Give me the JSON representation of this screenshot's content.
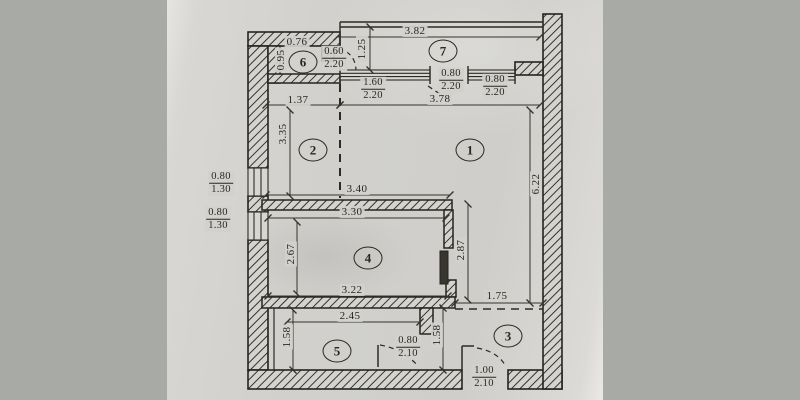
{
  "scene": {
    "margin_color": "#a8aaa5",
    "paper_color": "#d2d1cd",
    "line_color": "#29271f"
  },
  "plan": {
    "rooms": [
      {
        "number": "1",
        "x": 470,
        "y": 150
      },
      {
        "number": "2",
        "x": 313,
        "y": 150
      },
      {
        "number": "3",
        "x": 508,
        "y": 336
      },
      {
        "number": "4",
        "x": 368,
        "y": 258
      },
      {
        "number": "5",
        "x": 337,
        "y": 351
      },
      {
        "number": "6",
        "x": 303,
        "y": 62
      },
      {
        "number": "7",
        "x": 443,
        "y": 51
      }
    ],
    "dimensions": [
      {
        "text": "3.82",
        "x": 415,
        "y": 31,
        "rot": 0
      },
      {
        "text": "0.76",
        "x": 297,
        "y": 42,
        "rot": 0
      },
      {
        "text": "0.95",
        "x": 281,
        "y": 60,
        "rot": 1
      },
      {
        "text": "1.25",
        "x": 362,
        "y": 49,
        "rot": 1
      },
      {
        "text": "1.37",
        "x": 298,
        "y": 100,
        "rot": 0
      },
      {
        "text": "3.78",
        "x": 440,
        "y": 99,
        "rot": 0
      },
      {
        "text": "3.35",
        "x": 283,
        "y": 134,
        "rot": 1
      },
      {
        "text": "3.40",
        "x": 357,
        "y": 189,
        "rot": 0
      },
      {
        "text": "6.22",
        "x": 536,
        "y": 184,
        "rot": 1
      },
      {
        "text": "3.30",
        "x": 352,
        "y": 212,
        "rot": 0
      },
      {
        "text": "2.67",
        "x": 291,
        "y": 254,
        "rot": 1
      },
      {
        "text": "2.87",
        "x": 461,
        "y": 250,
        "rot": 1
      },
      {
        "text": "3.22",
        "x": 352,
        "y": 290,
        "rot": 0
      },
      {
        "text": "1.75",
        "x": 497,
        "y": 296,
        "rot": 0
      },
      {
        "text": "2.45",
        "x": 350,
        "y": 316,
        "rot": 0
      },
      {
        "text": "1.58",
        "x": 287,
        "y": 337,
        "rot": 1
      },
      {
        "text": "1.58",
        "x": 437,
        "y": 335,
        "rot": 1
      }
    ],
    "openings": [
      {
        "top": "0.60",
        "bottom": "2.20",
        "x": 334,
        "y": 58
      },
      {
        "top": "1.60",
        "bottom": "2.20",
        "x": 373,
        "y": 89
      },
      {
        "top": "0.80",
        "bottom": "2.20",
        "x": 451,
        "y": 80
      },
      {
        "top": "0.80",
        "bottom": "2.20",
        "x": 495,
        "y": 86
      },
      {
        "top": "0.80",
        "bottom": "1.30",
        "x": 221,
        "y": 183
      },
      {
        "top": "0.80",
        "bottom": "1.30",
        "x": 218,
        "y": 219
      },
      {
        "top": "0.80",
        "bottom": "2.10",
        "x": 408,
        "y": 347
      },
      {
        "top": "1.00",
        "bottom": "2.10",
        "x": 484,
        "y": 377
      }
    ]
  }
}
